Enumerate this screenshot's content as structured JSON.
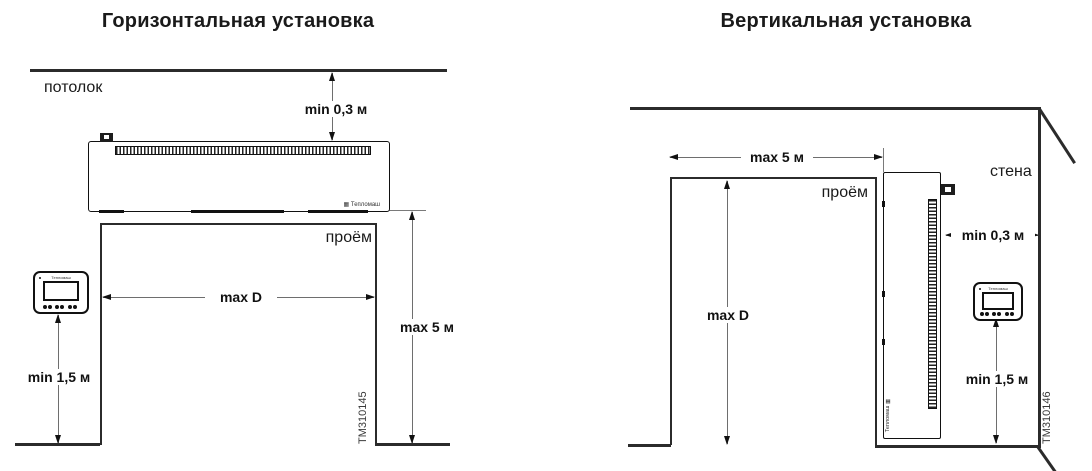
{
  "brand": "Тепломаш",
  "left": {
    "title": "Горизонтальная установка",
    "ceiling_label": "потолок",
    "opening_label": "проём",
    "dim_ceiling_gap": "min 0,3 м",
    "dim_opening_width": "max D",
    "dim_opening_height": "max 5 м",
    "dim_remote_height": "min 1,5 м",
    "figure_id": "TM310145"
  },
  "right": {
    "title": "Вертикальная установка",
    "wall_label": "стена",
    "opening_label": "проём",
    "dim_opening_width": "max 5 м",
    "dim_opening_height": "max D",
    "dim_wall_gap": "min 0,3 м",
    "dim_remote_height": "min 1,5 м",
    "figure_id": "TM310146"
  },
  "colors": {
    "background": "#ffffff",
    "structure_line": "#2b2b2b",
    "dimension_line": "#6e6e6e",
    "text": "#111111"
  }
}
